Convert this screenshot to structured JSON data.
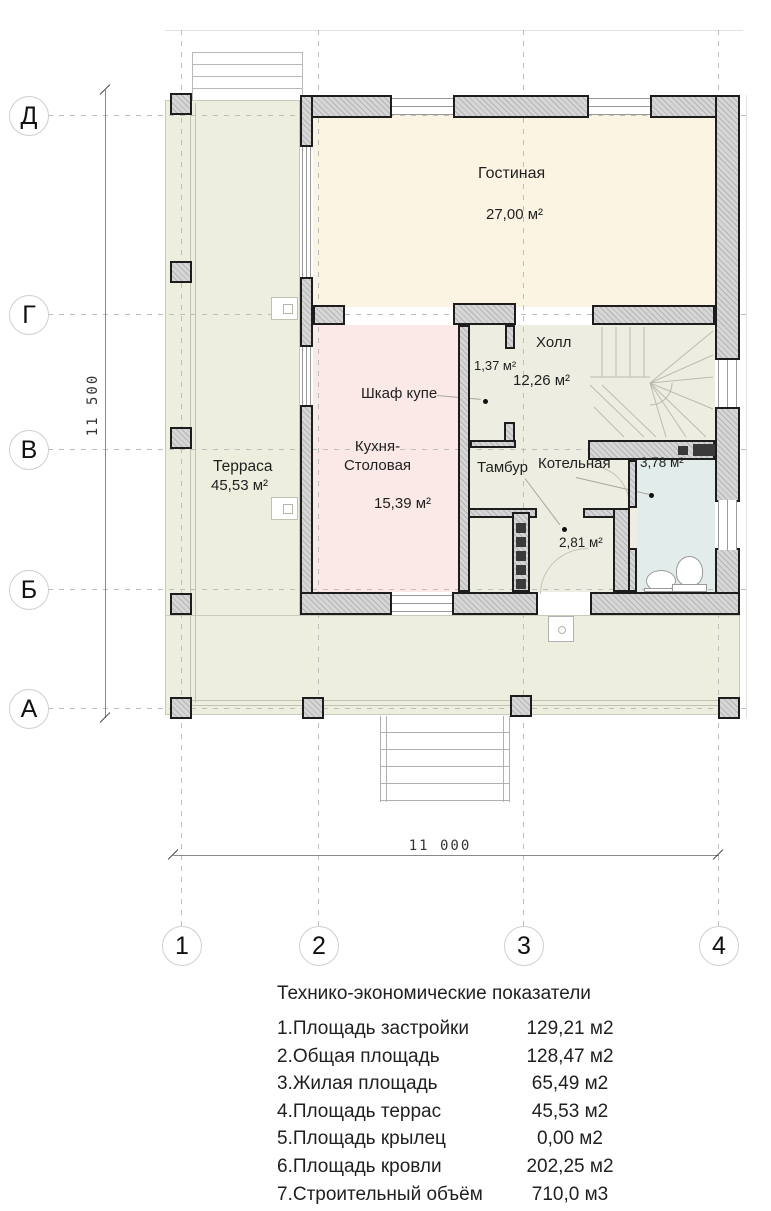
{
  "axes": {
    "rows": [
      "Д",
      "Г",
      "В",
      "Б",
      "А"
    ],
    "cols": [
      "1",
      "2",
      "3",
      "4"
    ]
  },
  "dimensions": {
    "height": "11 500",
    "width": "11 000"
  },
  "rooms": {
    "living": {
      "name": "Гостиная",
      "area": "27,00 м²"
    },
    "hall": {
      "name": "Холл",
      "area": "12,26 м²"
    },
    "closet": {
      "name": "Шкаф купе",
      "area": "1,37 м²"
    },
    "kitchen": {
      "name": "Кухня-Столовая",
      "area": "15,39 м²"
    },
    "terrace": {
      "name": "Терраса",
      "area": "45,53 м²"
    },
    "vestibule": {
      "name": "Тамбур",
      "area": "2,81 м²"
    },
    "boiler": {
      "name": "Котельная",
      "area": "3,78 м²"
    }
  },
  "summary": {
    "title": "Технико-экономические показатели",
    "rows": [
      {
        "label": "1.Площадь застройки",
        "value": "129,21 м2"
      },
      {
        "label": "2.Общая площадь",
        "value": "128,47 м2"
      },
      {
        "label": "3.Жилая площадь",
        "value": "65,49 м2"
      },
      {
        "label": "4.Площадь террас",
        "value": "45,53 м2"
      },
      {
        "label": "5.Площадь крылец",
        "value": "0,00 м2"
      },
      {
        "label": "6.Площадь кровли",
        "value": "202,25 м2"
      },
      {
        "label": "7.Строительный объём",
        "value": "710,0 м3"
      }
    ]
  },
  "colors": {
    "terrace": "#edeedd",
    "living": "#fbf4e3",
    "kitchen": "#fae9e7",
    "service": "#edeee1",
    "boiler": "#e2eceb",
    "wall_fill": "#d6d6d6",
    "wall_outline": "#1d1d1d"
  }
}
